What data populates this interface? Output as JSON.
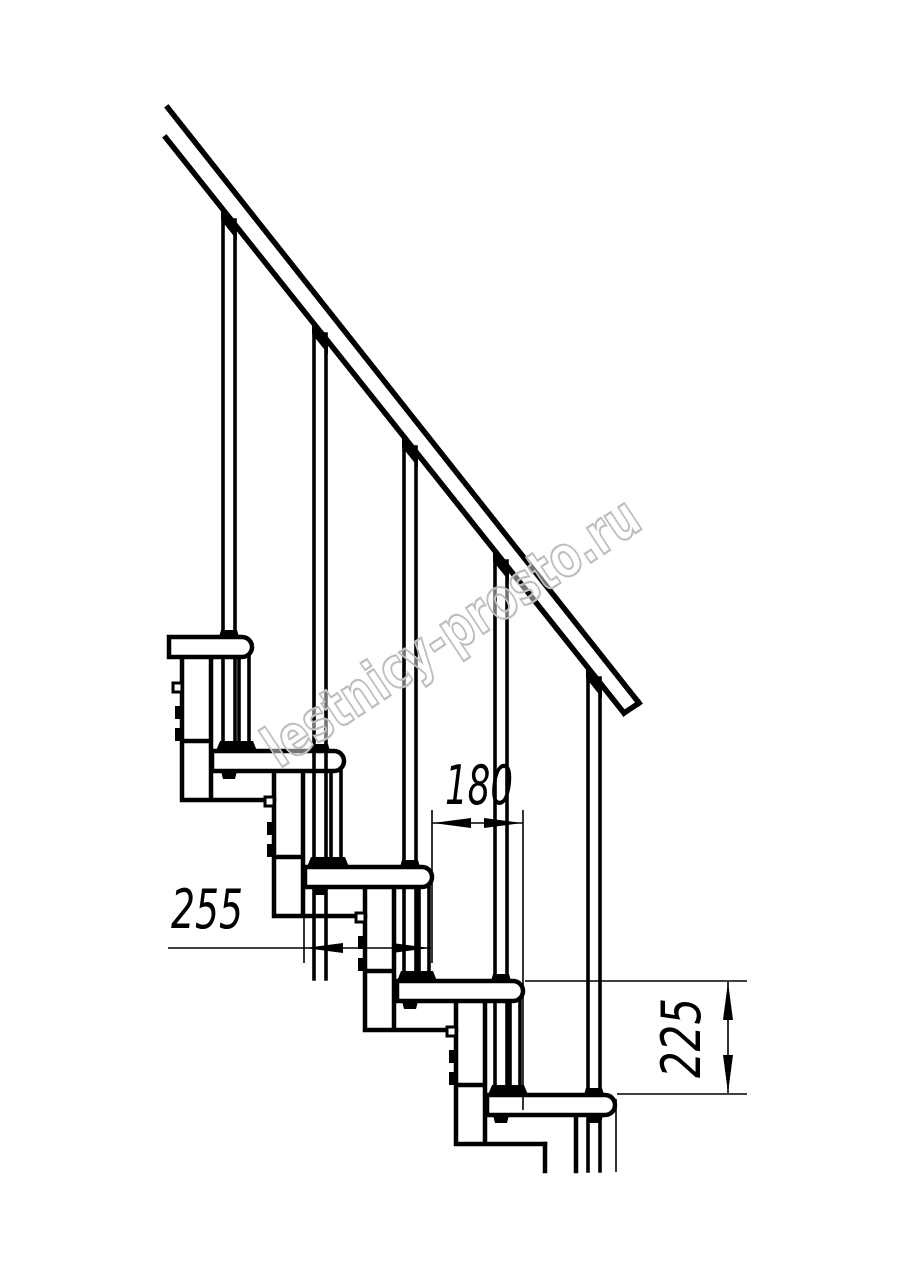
{
  "watermark": {
    "text": "lestnicy-prosto.ru",
    "color": "#bdbdbd"
  },
  "dimensions": {
    "tread_depth": {
      "value": "255"
    },
    "run": {
      "value": "180"
    },
    "rise": {
      "value": "225"
    }
  },
  "colors": {
    "line": "#000000",
    "background": "#ffffff"
  }
}
